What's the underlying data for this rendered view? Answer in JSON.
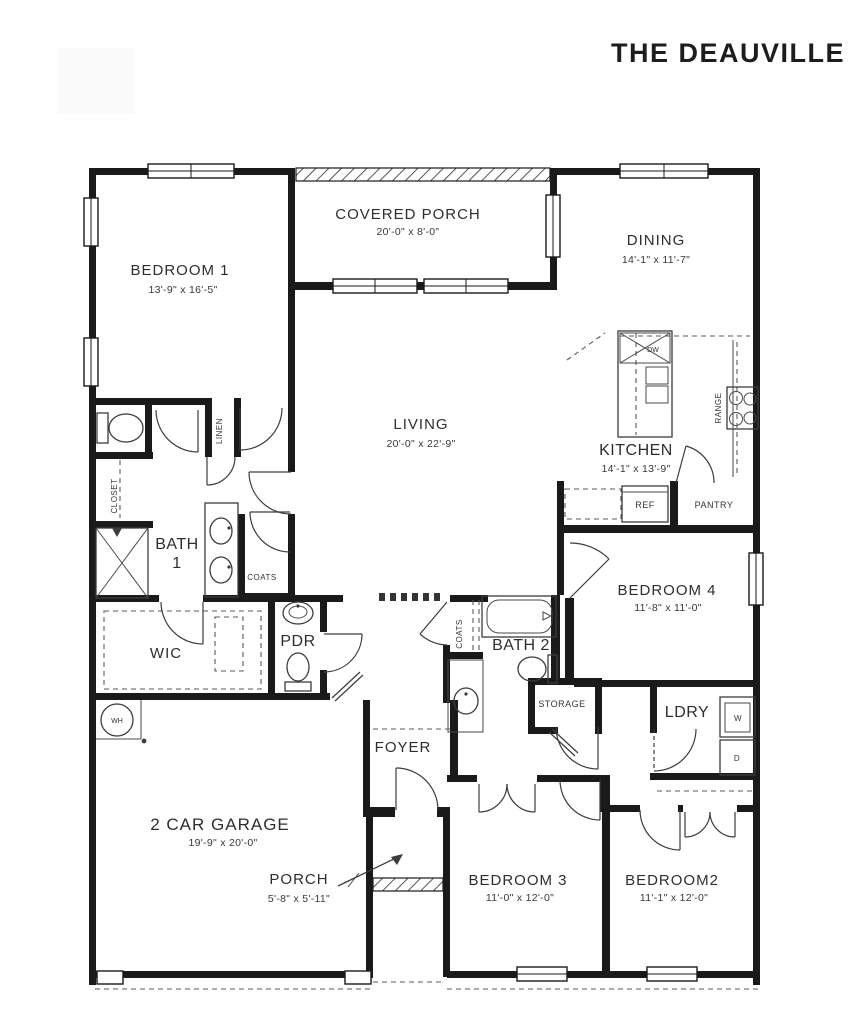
{
  "title": "THE DEAUVILLE",
  "rooms": {
    "bedroom1": {
      "label": "BEDROOM 1",
      "dims": "13'-9\" x 16'-5\""
    },
    "covered_porch": {
      "label": "COVERED PORCH",
      "dims": "20'-0\" x 8'-0\""
    },
    "dining": {
      "label": "DINING",
      "dims": "14'-1\" x 11'-7\""
    },
    "living": {
      "label": "LIVING",
      "dims": "20'-0\" x 22'-9\""
    },
    "kitchen": {
      "label": "KITCHEN",
      "dims": "14'-1\" x 13'-9\""
    },
    "bath1": {
      "label": "BATH",
      "number": "1"
    },
    "wic": {
      "label": "WIC"
    },
    "pdr": {
      "label": "PDR"
    },
    "bath2": {
      "label": "BATH 2"
    },
    "bedroom4": {
      "label": "BEDROOM 4",
      "dims": "11'-8\" x 11'-0\""
    },
    "laundry": {
      "label": "LDRY"
    },
    "storage": {
      "label": "STORAGE"
    },
    "garage": {
      "label": "2 CAR GARAGE",
      "dims": "19'-9\" x 20'-0\""
    },
    "foyer": {
      "label": "FOYER"
    },
    "porch": {
      "label": "PORCH",
      "dims": "5'-8\" x 5'-11\""
    },
    "bedroom3": {
      "label": "BEDROOM 3",
      "dims": "11'-0\" x 12'-0\""
    },
    "bedroom2": {
      "label": "BEDROOM2",
      "dims": "11'-1\" x 12'-0\""
    }
  },
  "fixtures": {
    "linen": "LINEN",
    "closet": "CLOSET",
    "coats_bath1": "COATS",
    "coats_hall": "COATS",
    "ref": "REF",
    "pantry": "PANTRY",
    "range": "RANGE",
    "dishwasher": "DW",
    "water_heater": "WH",
    "washer": "W",
    "dryer": "D"
  },
  "colors": {
    "wall": "#1a1a1a",
    "text": "#2e2e2e",
    "line": "#3c3c3c"
  }
}
